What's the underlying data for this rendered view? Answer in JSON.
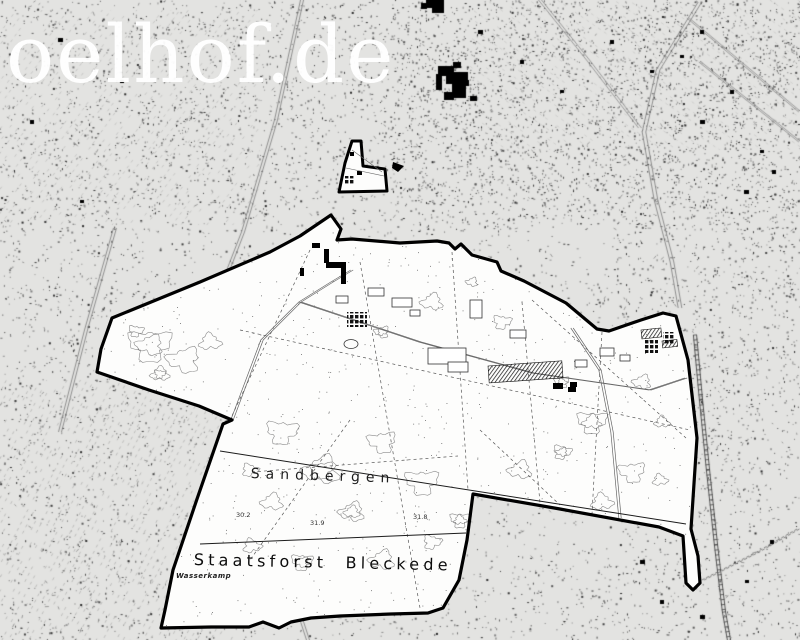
{
  "watermark": {
    "text": "oelhof.de",
    "color": "#ffffff"
  },
  "map_labels": {
    "forest_area": "Sandbergen",
    "state_forest": "Staatsforst Bleckede",
    "field_name": "Wasserkamp"
  },
  "spot_heights": [
    {
      "value": "30.2",
      "x": 236,
      "y": 511
    },
    {
      "value": "31.9",
      "x": 310,
      "y": 519
    },
    {
      "value": "31.8",
      "x": 413,
      "y": 513
    }
  ],
  "colors": {
    "paper": "#e3e3e1",
    "interior": "#fdfdfc",
    "boundary": "#000000",
    "contour": "#8a8a8a",
    "detail": "#555555",
    "watermark": "#ffffff"
  }
}
